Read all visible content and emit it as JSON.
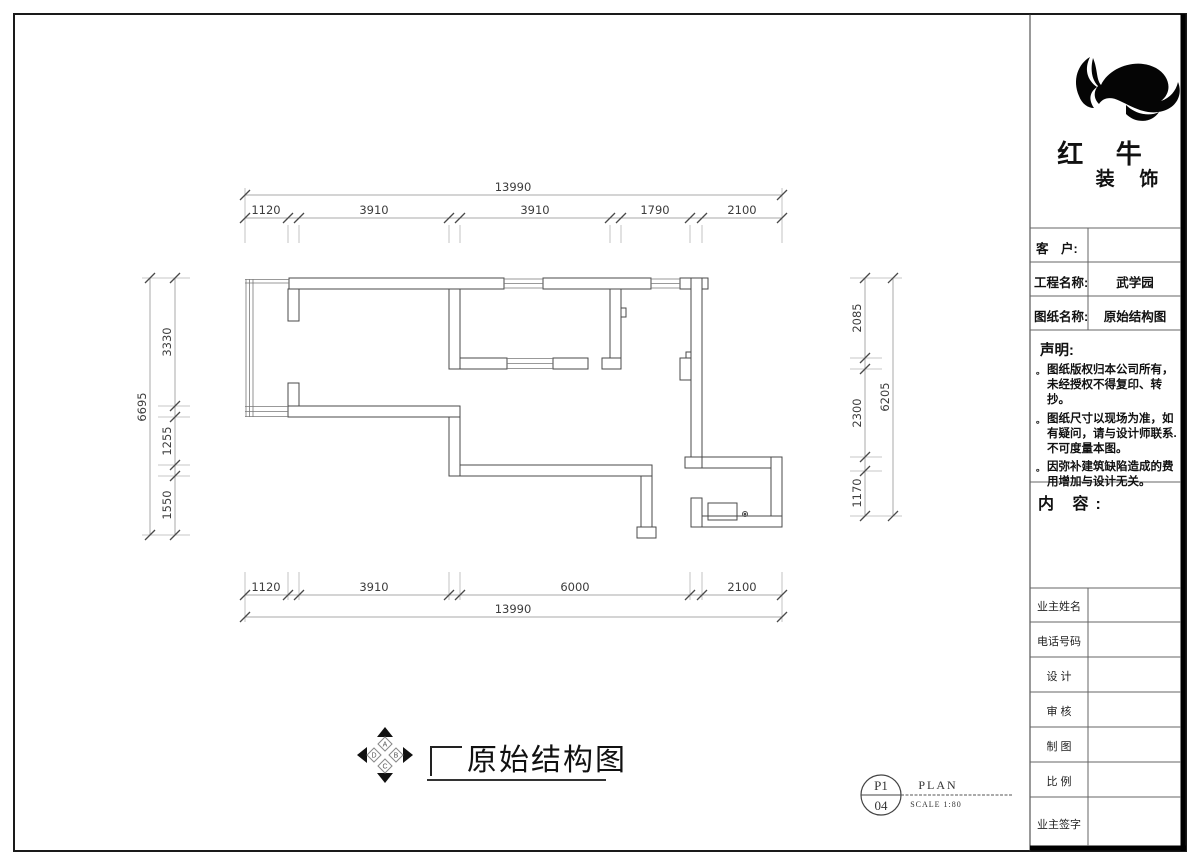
{
  "title_block": {
    "company_name_1": "红 牛",
    "company_name_2": "装 饰",
    "logo_icon": "bull-swoosh-logo",
    "fields": [
      {
        "label": "客　户:",
        "value": ""
      },
      {
        "label": "工程名称:",
        "value": "武学园"
      },
      {
        "label": "图纸名称:",
        "value": "原始结构图"
      }
    ],
    "statement_heading": "声明:",
    "statement_items": [
      "图纸版权归本公司所有，未经授权不得复印、转抄。",
      "图纸尺寸以现场为准，如有疑问，请与设计师联系. 不可度量本图。",
      "因弥补建筑缺陷造成的费用增加与设计无关。"
    ],
    "content_heading": "内 容:",
    "signature_rows": [
      {
        "label": "业主姓名"
      },
      {
        "label": "电话号码"
      },
      {
        "label": "设 计"
      },
      {
        "label": "审 核"
      },
      {
        "label": "制 图"
      },
      {
        "label": "比 例"
      },
      {
        "label": "业主签字"
      }
    ]
  },
  "drawing": {
    "caption": "原始结构图",
    "compass_letters": [
      "A",
      "B",
      "C",
      "D"
    ],
    "dimensions": {
      "top": {
        "overall": "13990",
        "segments": [
          "1120",
          "3910",
          "3910",
          "1790",
          "2100"
        ]
      },
      "bottom": {
        "overall": "13990",
        "segments": [
          "1120",
          "3910",
          "6000",
          "2100"
        ]
      },
      "left": {
        "overall": "6695",
        "segments": [
          "3330",
          "1255",
          "1550"
        ]
      },
      "right": {
        "overall": "6205",
        "segments": [
          "2085",
          "2300",
          "1170"
        ]
      }
    },
    "sheet_ref": {
      "code_top": "P1",
      "code_bottom": "04",
      "label": "PLAN",
      "scale": "SCALE 1:80"
    }
  }
}
